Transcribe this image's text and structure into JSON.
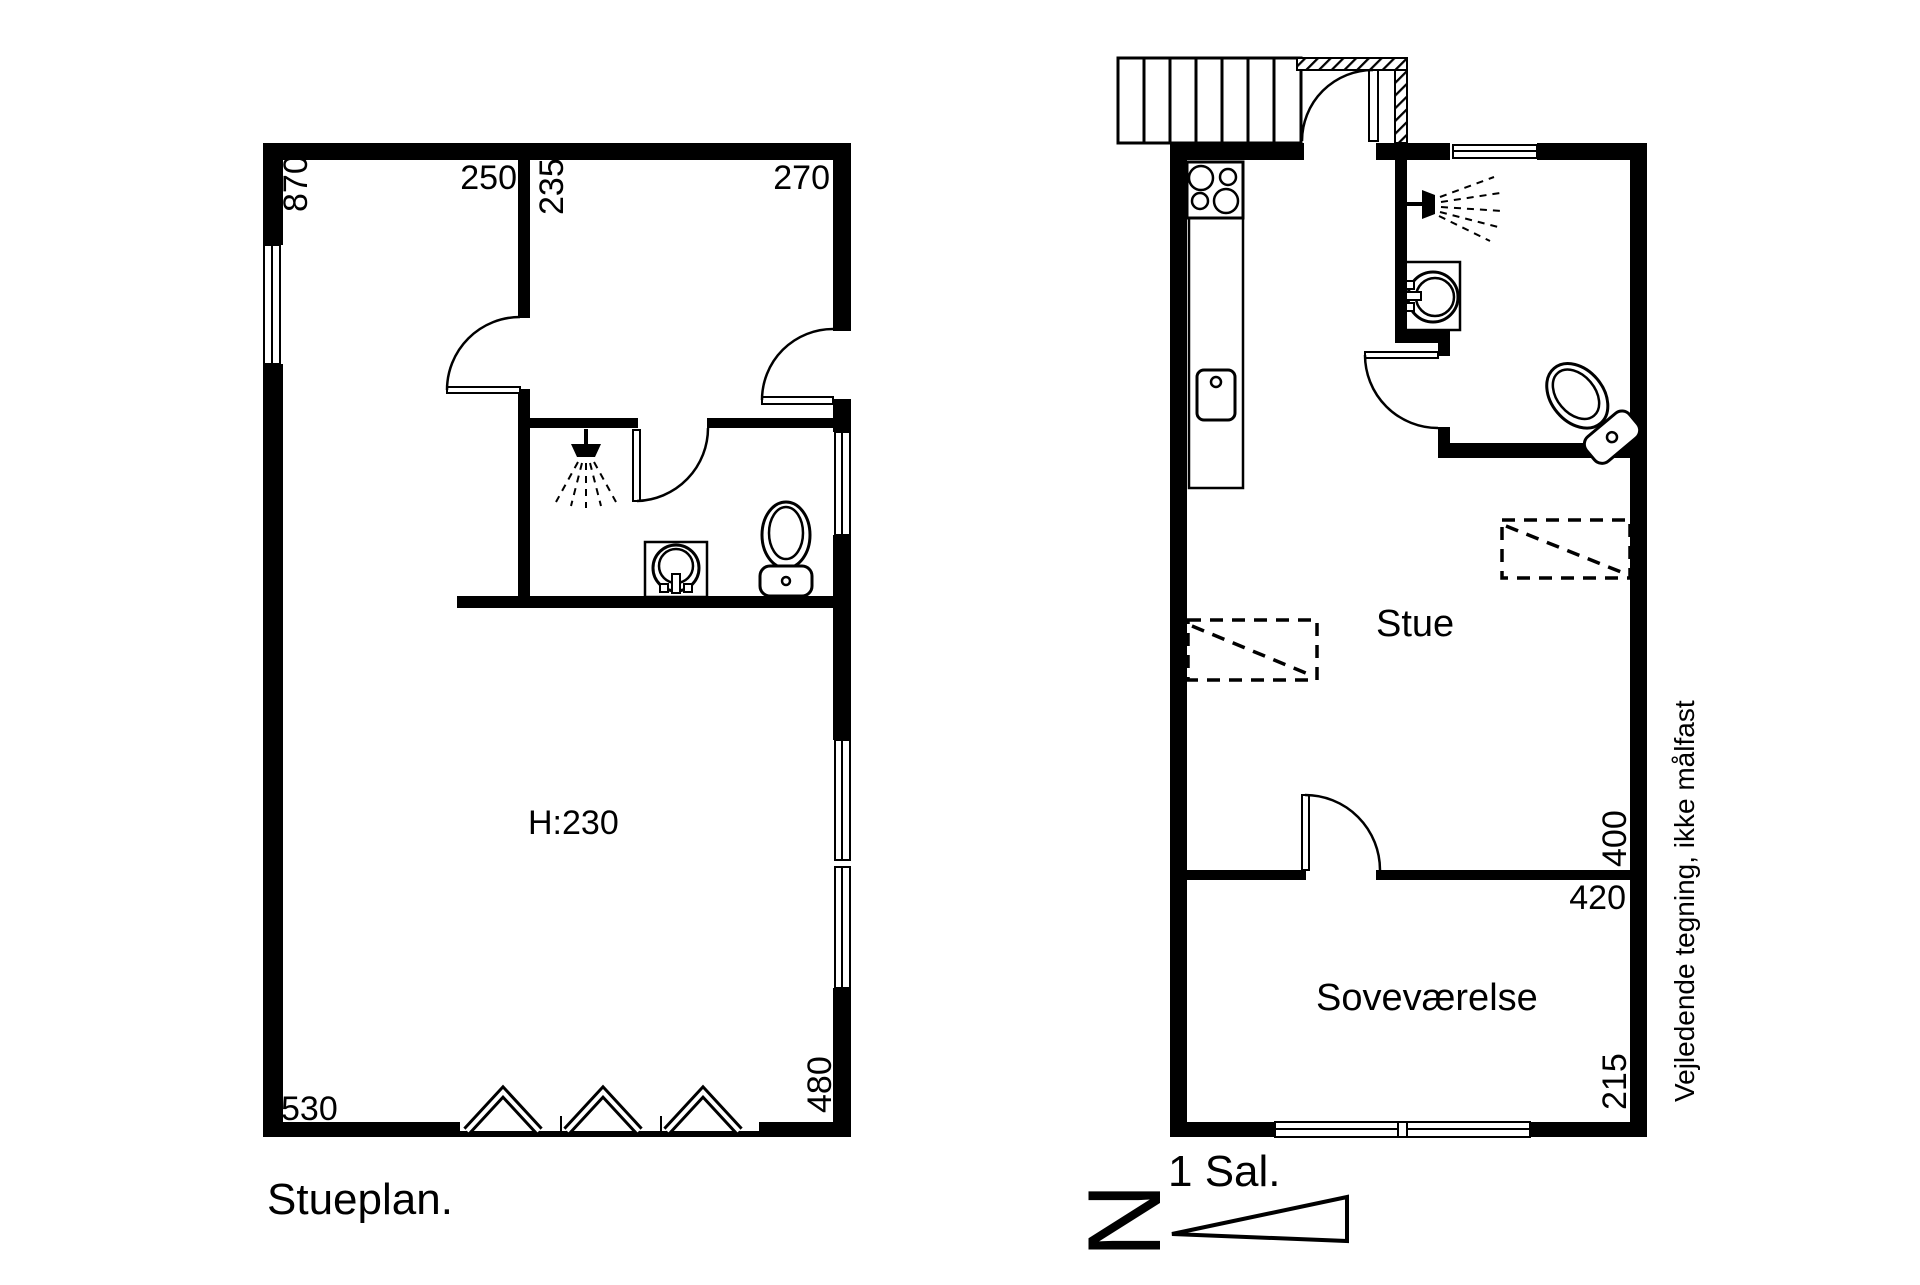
{
  "page": {
    "background": "#ffffff",
    "ink": "#000000"
  },
  "left_plan": {
    "title": "Stueplan.",
    "ceiling_height": "H:230",
    "dims": {
      "left_height": "870",
      "top_left_width": "250",
      "inner_room_height": "235",
      "top_right_width": "270",
      "bottom_left_width": "530",
      "bottom_right_height": "480"
    }
  },
  "right_plan": {
    "title": "1 Sal.",
    "rooms": {
      "living": "Stue",
      "bedroom": "Soveværelse"
    },
    "dims": {
      "living_height": "400",
      "bedroom_top_width": "420",
      "bedroom_right_height": "215"
    }
  },
  "compass": {
    "north_letter": "N"
  },
  "note": {
    "disclaimer": "Vejledende tegning, ikke målfast"
  }
}
